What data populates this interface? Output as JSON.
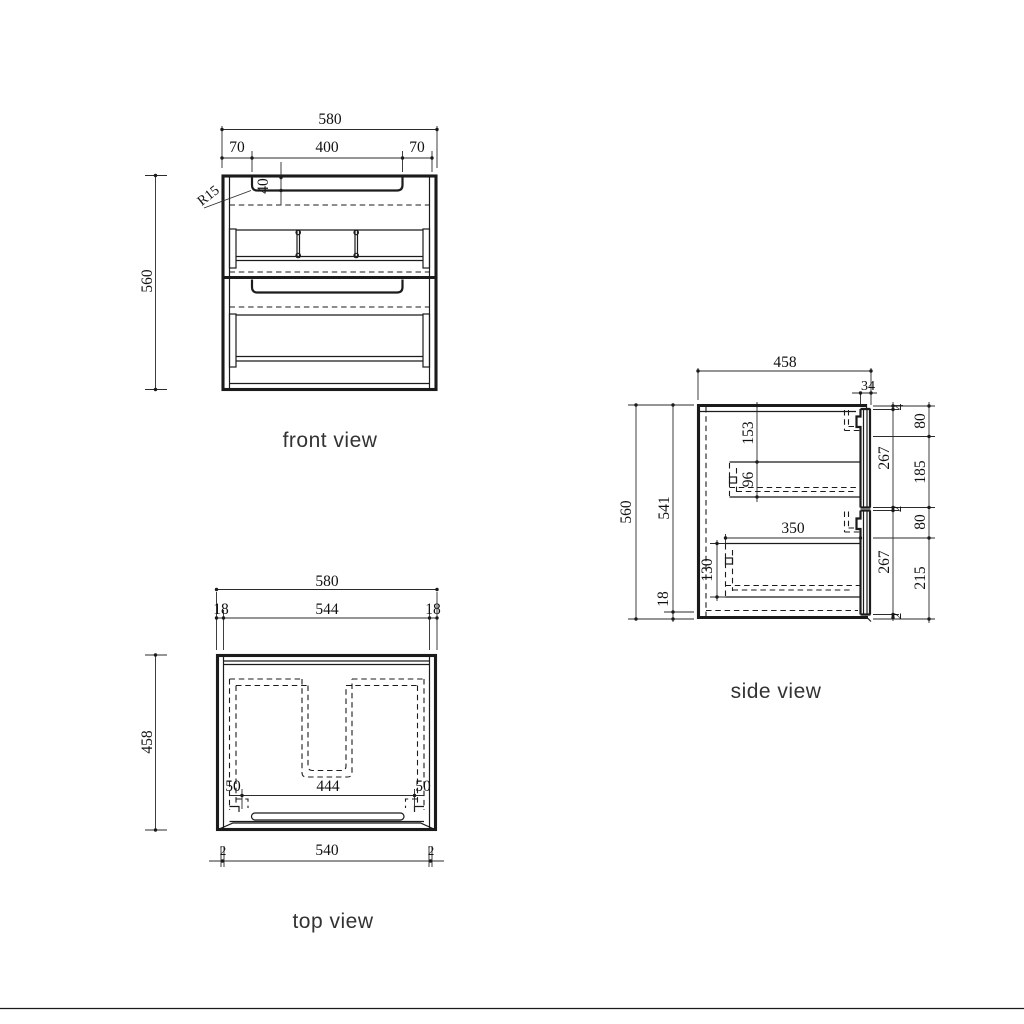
{
  "views": {
    "front": {
      "label": "front view",
      "dims": {
        "overall_width": "580",
        "recess_offset_left": "70",
        "recess_width": "400",
        "recess_offset_right": "70",
        "overall_height": "560",
        "corner_radius": "R15",
        "recess_depth": "40"
      }
    },
    "top": {
      "label": "top view",
      "dims": {
        "overall_width": "580",
        "side_left": "18",
        "inner_width": "544",
        "side_right": "18",
        "overall_depth": "458",
        "cutout_left": "50",
        "cutout_width": "444",
        "cutout_right": "50",
        "gap_left": "2",
        "front_width": "540",
        "gap_right": "2"
      }
    },
    "side": {
      "label": "side view",
      "dims": {
        "overall_depth": "458",
        "front_thickness": "34",
        "overall_height": "560",
        "carcass_height": "541",
        "bottom_panel": "18",
        "top_offset": "153",
        "upper_box_height": "96",
        "lower_box_depth": "350",
        "lower_box_height": "130",
        "top_gap": "4",
        "upper_front": "267",
        "mid_gap": "2",
        "lower_front": "267",
        "bottom_gap": "2",
        "r1": "80",
        "r2": "185",
        "r3": "80",
        "r4": "215"
      }
    }
  },
  "colors": {
    "line": "#1b1b1b",
    "dimension": "#2b2b2b",
    "label": "#333333",
    "background": "#ffffff"
  }
}
